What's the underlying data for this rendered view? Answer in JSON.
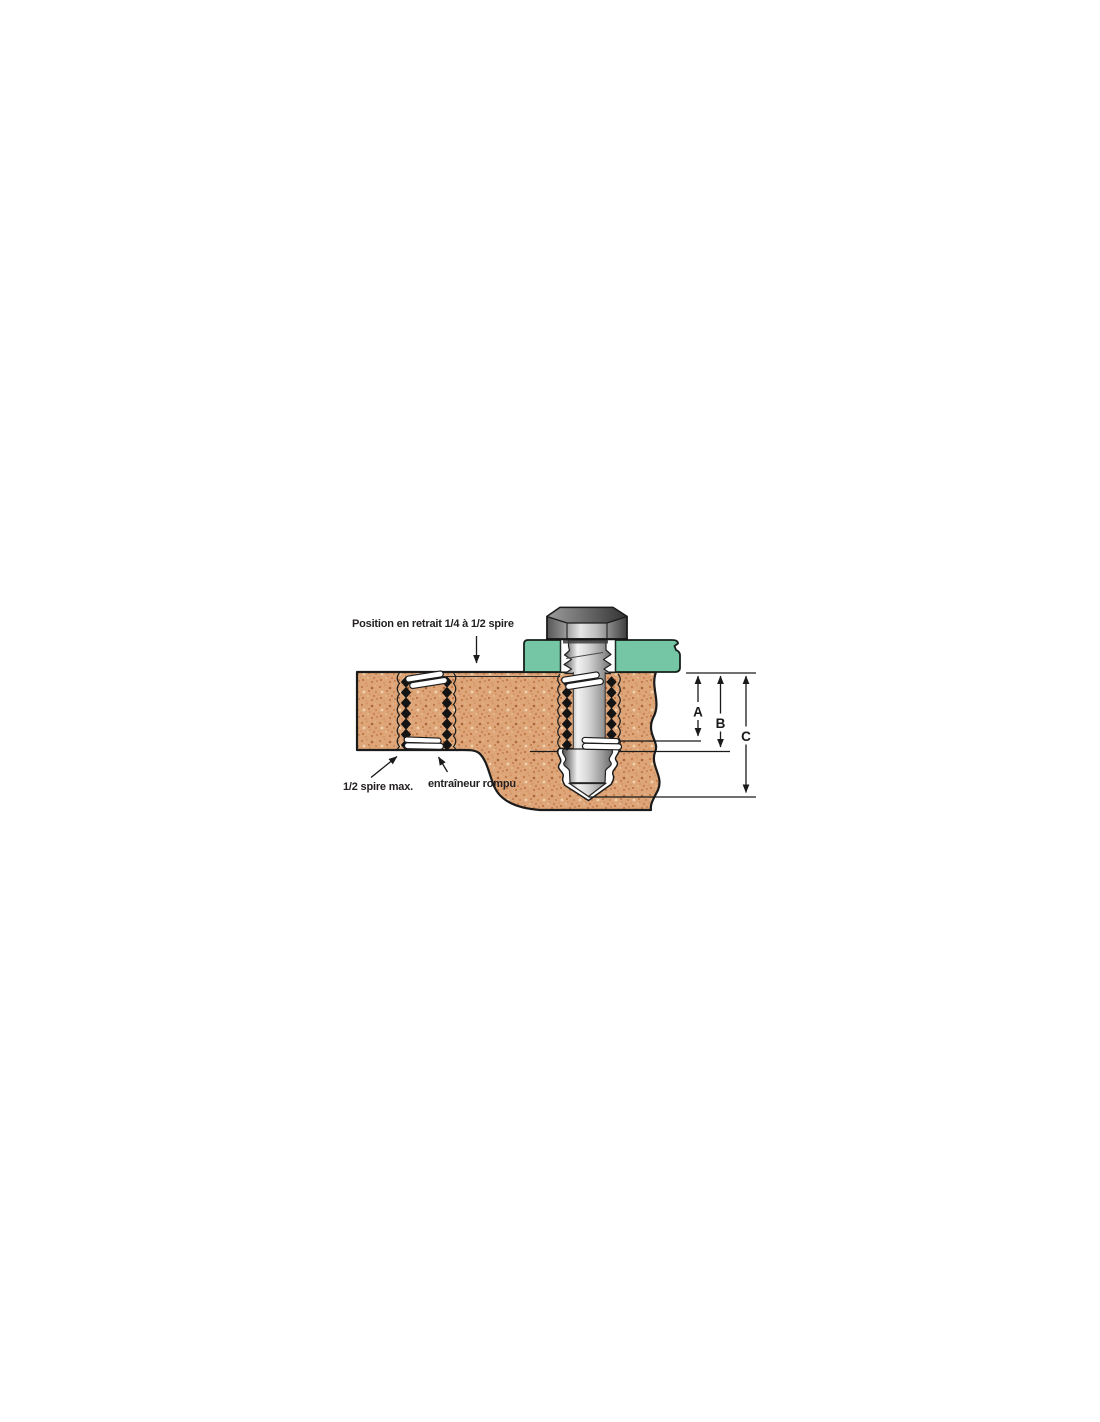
{
  "figure": {
    "type": "technical-cross-section-diagram",
    "subject": "threaded-insert-installation",
    "annotations": {
      "position_retrait": "Position en retrait 1/4 à 1/2 spire",
      "demi_spire": "1/2 spire max.",
      "entraineur": "entraîneur rompu"
    },
    "dimensions": {
      "a": "A",
      "b": "B",
      "c": "C"
    },
    "colors": {
      "background": "#FFFFFF",
      "material_tan": "#DDA578",
      "material_speckle_dark": "#C07946",
      "material_speckle_deep": "#AC6538",
      "material_speckle_light": "#F0D2AC",
      "plate_green": "#74C6A4",
      "metal_light": "#F2F2F2",
      "metal_dark": "#3F3F3F",
      "thread_black": "#141414",
      "outline": "#1B1B1B",
      "text": "#231F20"
    }
  }
}
